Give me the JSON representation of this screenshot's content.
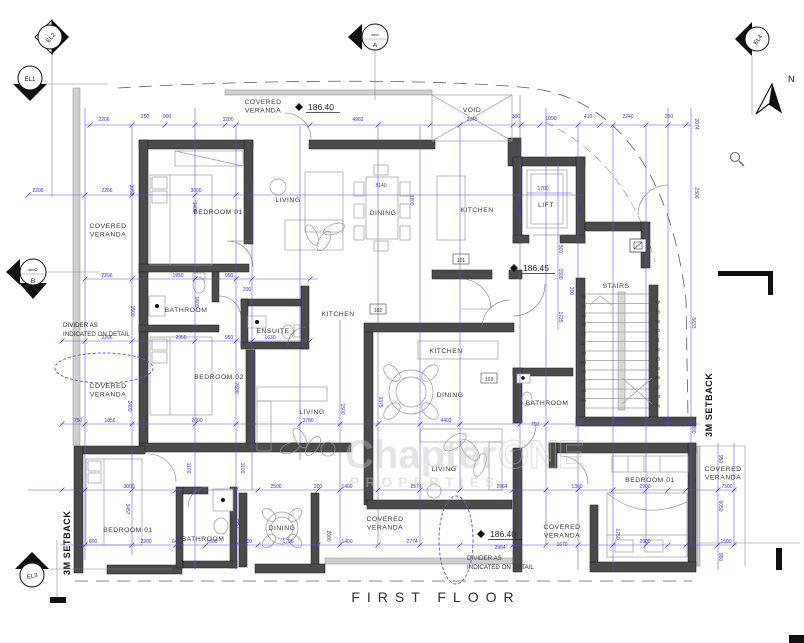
{
  "title": "FIRST FLOOR",
  "watermark": {
    "part1": "Chapter",
    "part2": "ONE",
    "line2": "PROPERTIES"
  },
  "colors": {
    "dimension_blue": "#3d35c4",
    "wall_gray": "#4b4b4b",
    "cloud_violet": "#6a5fd0"
  },
  "markers": {
    "north_label": "N",
    "elevation": [
      {
        "id": "EL1"
      },
      {
        "id": "EL2"
      },
      {
        "id": "EL3"
      },
      {
        "id": "EL4"
      }
    ],
    "sections": [
      {
        "label": "sect",
        "letter": "A"
      },
      {
        "label": "sect2",
        "letter": "B"
      }
    ],
    "levels": [
      {
        "v": "186.40",
        "x": 308,
        "y": 110
      },
      {
        "v": "186.45",
        "x": 523,
        "y": 271
      },
      {
        "v": "186.40",
        "x": 490,
        "y": 537
      }
    ],
    "room_tags": [
      {
        "t": "101",
        "x": 461,
        "y": 262
      },
      {
        "t": "102",
        "x": 378,
        "y": 312
      },
      {
        "t": "103",
        "x": 489,
        "y": 381
      }
    ],
    "setback_labels": [
      {
        "t": "3M SETBACK",
        "x": 712,
        "y": 437
      },
      {
        "t": "3M SETBACK",
        "x": 70,
        "y": 575
      }
    ],
    "divider_notes": [
      {
        "line1": "DIVIDER AS",
        "line2": "INDICATED ON DETAIL",
        "x": 63,
        "y": 327
      },
      {
        "line1": "DIVIDER AS",
        "line2": "INDICATED ON DETAIL",
        "x": 467,
        "y": 560
      }
    ]
  },
  "rooms": [
    {
      "lines": [
        "BEDROOM 01"
      ],
      "x": 218,
      "y": 214
    },
    {
      "lines": [
        "LIVING"
      ],
      "x": 288,
      "y": 202
    },
    {
      "lines": [
        "DINING"
      ],
      "x": 383,
      "y": 215
    },
    {
      "lines": [
        "KITCHEN"
      ],
      "x": 477,
      "y": 212
    },
    {
      "lines": [
        "LIFT"
      ],
      "x": 546,
      "y": 207
    },
    {
      "lines": [
        "VOID"
      ],
      "x": 472,
      "y": 112
    },
    {
      "lines": [
        "COVERED",
        "VERANDA"
      ],
      "x": 263,
      "y": 104
    },
    {
      "lines": [
        "COVERED",
        "VERANDA"
      ],
      "x": 108,
      "y": 228
    },
    {
      "lines": [
        "COVERED",
        "VERANDA"
      ],
      "x": 108,
      "y": 388
    },
    {
      "lines": [
        "BATHROOM"
      ],
      "x": 186,
      "y": 312
    },
    {
      "lines": [
        "ENSUITE"
      ],
      "x": 273,
      "y": 333
    },
    {
      "lines": [
        "KITCHEN"
      ],
      "x": 338,
      "y": 316
    },
    {
      "lines": [
        "KITCHEN"
      ],
      "x": 446,
      "y": 353
    },
    {
      "lines": [
        "DINING"
      ],
      "x": 450,
      "y": 397
    },
    {
      "lines": [
        "BEDROOM 02"
      ],
      "x": 219,
      "y": 379
    },
    {
      "lines": [
        "LIVING"
      ],
      "x": 312,
      "y": 414
    },
    {
      "lines": [
        "STAIRS"
      ],
      "x": 616,
      "y": 288
    },
    {
      "lines": [
        "BATHROOM"
      ],
      "x": 547,
      "y": 405
    },
    {
      "lines": [
        "BEDROOM 01"
      ],
      "x": 128,
      "y": 532
    },
    {
      "lines": [
        "BATHROOM"
      ],
      "x": 203,
      "y": 541
    },
    {
      "lines": [
        "DINING"
      ],
      "x": 282,
      "y": 530
    },
    {
      "lines": [
        "COVERED",
        "VERANDA"
      ],
      "x": 385,
      "y": 521
    },
    {
      "lines": [
        "LIVING"
      ],
      "x": 444,
      "y": 471
    },
    {
      "lines": [
        "COVERED",
        "VERANDA"
      ],
      "x": 562,
      "y": 529
    },
    {
      "lines": [
        "BEDROOM 01"
      ],
      "x": 650,
      "y": 482
    },
    {
      "lines": [
        "COVERED",
        "VERANDA"
      ],
      "x": 723,
      "y": 471
    }
  ],
  "stairs": {
    "label": "STAIRS",
    "left_steps": [
      "16",
      "15",
      "14",
      "13",
      "12",
      "11",
      "10",
      "09",
      "08",
      "07",
      "06",
      "05"
    ],
    "right_steps": [
      "17",
      "18",
      "19",
      "20",
      "21",
      "22",
      "23",
      "24",
      "25",
      "26",
      "03",
      "04"
    ]
  },
  "dimensions": [
    {
      "t": "2206",
      "x": 104,
      "y": 121
    },
    {
      "t": "250",
      "x": 145,
      "y": 118
    },
    {
      "t": "900",
      "x": 167,
      "y": 118
    },
    {
      "t": "3200",
      "x": 228,
      "y": 121
    },
    {
      "t": "4962",
      "x": 358,
      "y": 121
    },
    {
      "t": "2345",
      "x": 472,
      "y": 121
    },
    {
      "t": "300",
      "x": 516,
      "y": 118
    },
    {
      "t": "1090",
      "x": 551,
      "y": 120
    },
    {
      "t": "410",
      "x": 588,
      "y": 118
    },
    {
      "t": "2240",
      "x": 628,
      "y": 118
    },
    {
      "t": "250",
      "x": 669,
      "y": 118
    },
    {
      "t": "2074",
      "x": 695,
      "y": 124,
      "r": 90
    },
    {
      "t": "2306",
      "x": 695,
      "y": 193,
      "r": 90
    },
    {
      "t": "2206",
      "x": 38,
      "y": 192
    },
    {
      "t": "2206",
      "x": 107,
      "y": 192
    },
    {
      "t": "3000",
      "x": 196,
      "y": 192
    },
    {
      "t": "8140",
      "x": 381,
      "y": 187
    },
    {
      "t": "3200",
      "x": 410,
      "y": 200,
      "r": 90
    },
    {
      "t": "3950",
      "x": 130,
      "y": 190,
      "r": 90
    },
    {
      "t": "3400",
      "x": 193,
      "y": 207,
      "r": 90
    },
    {
      "t": "1700",
      "x": 543,
      "y": 190
    },
    {
      "t": "740",
      "x": 517,
      "y": 206,
      "r": 90
    },
    {
      "t": "750",
      "x": 578,
      "y": 206,
      "r": 90
    },
    {
      "t": "500",
      "x": 559,
      "y": 249,
      "r": 90
    },
    {
      "t": "1500",
      "x": 559,
      "y": 274,
      "r": 90
    },
    {
      "t": "200",
      "x": 570,
      "y": 291,
      "r": 90
    },
    {
      "t": "1725",
      "x": 559,
      "y": 317,
      "r": 90
    },
    {
      "t": "2206",
      "x": 107,
      "y": 277
    },
    {
      "t": "1950",
      "x": 178,
      "y": 277
    },
    {
      "t": "950",
      "x": 229,
      "y": 277
    },
    {
      "t": "200",
      "x": 247,
      "y": 291
    },
    {
      "t": "1600",
      "x": 195,
      "y": 302,
      "r": 90
    },
    {
      "t": "1500",
      "x": 131,
      "y": 311,
      "r": 90
    },
    {
      "t": "2206",
      "x": 107,
      "y": 339
    },
    {
      "t": "2950",
      "x": 181,
      "y": 339
    },
    {
      "t": "950",
      "x": 229,
      "y": 339
    },
    {
      "t": "1630",
      "x": 270,
      "y": 339
    },
    {
      "t": "7600",
      "x": 235,
      "y": 388,
      "r": 90
    },
    {
      "t": "2400",
      "x": 128,
      "y": 406,
      "r": 90
    },
    {
      "t": "1500",
      "x": 341,
      "y": 409,
      "r": 90
    },
    {
      "t": "3375",
      "x": 379,
      "y": 402,
      "r": 90
    },
    {
      "t": "750",
      "x": 78,
      "y": 422
    },
    {
      "t": "1856",
      "x": 110,
      "y": 422
    },
    {
      "t": "2000",
      "x": 197,
      "y": 422
    },
    {
      "t": "3780",
      "x": 308,
      "y": 422
    },
    {
      "t": "4403",
      "x": 446,
      "y": 422
    },
    {
      "t": "2650",
      "x": 620,
      "y": 422
    },
    {
      "t": "250",
      "x": 666,
      "y": 422
    },
    {
      "t": "750",
      "x": 535,
      "y": 426
    },
    {
      "t": "5633",
      "x": 692,
      "y": 323,
      "r": 90
    },
    {
      "t": "1800",
      "x": 692,
      "y": 428,
      "r": 90
    },
    {
      "t": "3000",
      "x": 129,
      "y": 488
    },
    {
      "t": "2506",
      "x": 276,
      "y": 488
    },
    {
      "t": "200",
      "x": 318,
      "y": 488
    },
    {
      "t": "1400",
      "x": 347,
      "y": 488
    },
    {
      "t": "2574",
      "x": 416,
      "y": 488
    },
    {
      "t": "2964",
      "x": 502,
      "y": 488
    },
    {
      "t": "1360",
      "x": 577,
      "y": 488
    },
    {
      "t": "2900",
      "x": 645,
      "y": 488
    },
    {
      "t": "7500",
      "x": 727,
      "y": 488
    },
    {
      "t": "1100",
      "x": 187,
      "y": 468,
      "r": 90
    },
    {
      "t": "1100",
      "x": 241,
      "y": 468,
      "r": 90
    },
    {
      "t": "3457",
      "x": 126,
      "y": 509,
      "r": 90
    },
    {
      "t": "2557",
      "x": 236,
      "y": 523,
      "r": 90
    },
    {
      "t": "2000",
      "x": 327,
      "y": 536,
      "r": 90
    },
    {
      "t": "1750",
      "x": 616,
      "y": 534,
      "r": 90
    },
    {
      "t": "950",
      "x": 719,
      "y": 459,
      "r": 90
    },
    {
      "t": "6050",
      "x": 719,
      "y": 506,
      "r": 90
    },
    {
      "t": "950",
      "x": 719,
      "y": 557,
      "r": 90
    },
    {
      "t": "800",
      "x": 93,
      "y": 543
    },
    {
      "t": "2200",
      "x": 146,
      "y": 543
    },
    {
      "t": "640",
      "x": 176,
      "y": 543
    },
    {
      "t": "1000",
      "x": 212,
      "y": 543
    },
    {
      "t": "900",
      "x": 248,
      "y": 543
    },
    {
      "t": "1796",
      "x": 288,
      "y": 543
    },
    {
      "t": "1400",
      "x": 347,
      "y": 543
    },
    {
      "t": "2774",
      "x": 412,
      "y": 543
    },
    {
      "t": "2964",
      "x": 500,
      "y": 549
    },
    {
      "t": "1670",
      "x": 562,
      "y": 546
    },
    {
      "t": "2900",
      "x": 645,
      "y": 543
    },
    {
      "t": "1500",
      "x": 726,
      "y": 543
    }
  ]
}
